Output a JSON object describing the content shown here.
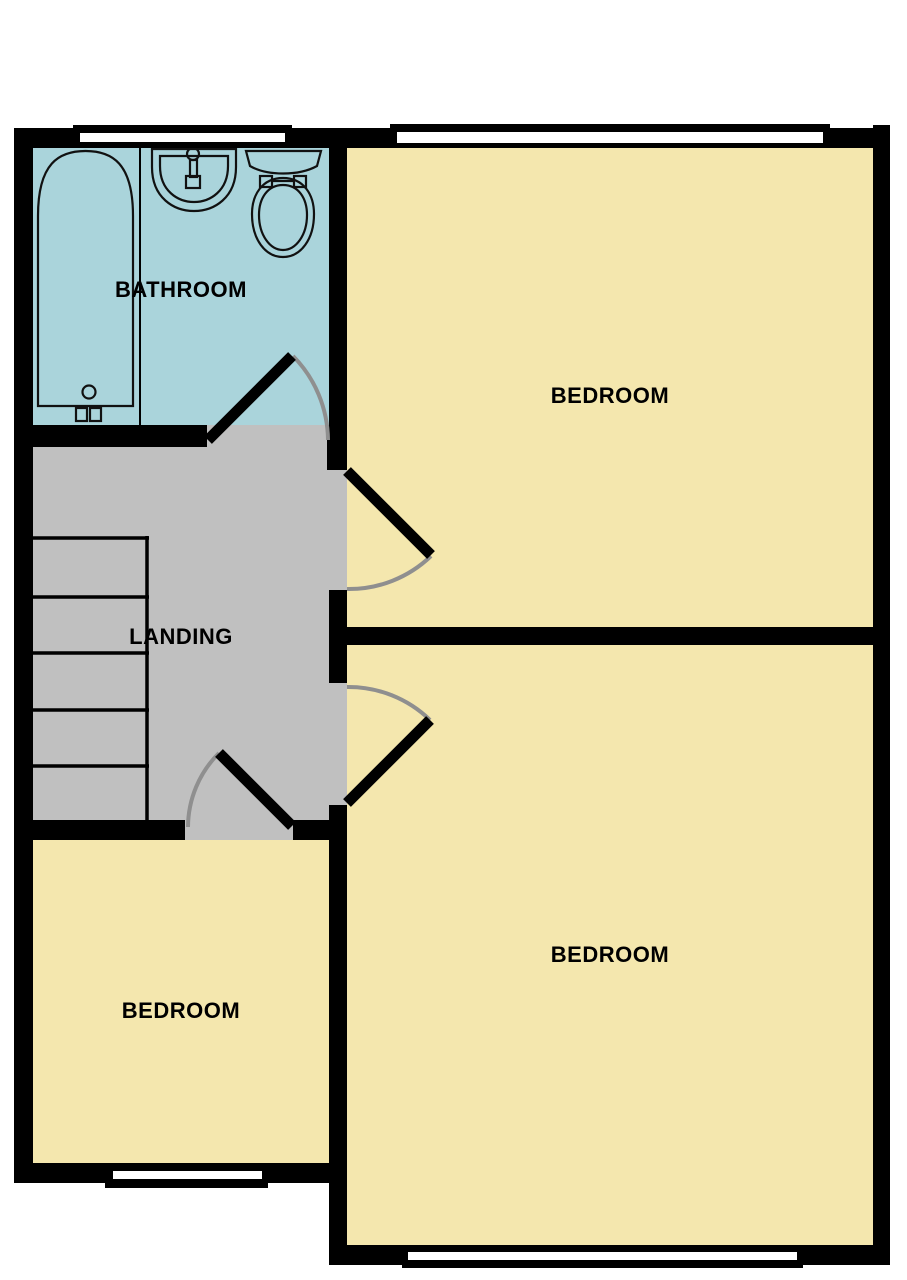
{
  "plan": {
    "type": "floorplan",
    "floor_labels_visible": 5,
    "colors": {
      "wall": "#000000",
      "bathroom_floor": "#aad4db",
      "bedroom_floor": "#f4e7ae",
      "landing_floor": "#c0c0c0",
      "window_glass": "#ffffff",
      "door_swing_arc": "#8f8f8f",
      "fixture_line": "#111111",
      "label_color": "#000000",
      "background": "#ffffff"
    },
    "rooms": {
      "bathroom": {
        "label": "BATHROOM"
      },
      "bedroom_top_right": {
        "label": "BEDROOM"
      },
      "landing": {
        "label": "LANDING"
      },
      "bedroom_bottom_right": {
        "label": "BEDROOM"
      },
      "bedroom_bottom_left": {
        "label": "BEDROOM"
      }
    },
    "fixtures": {
      "bath": "bath-tub-icon",
      "sink": "wash-basin-icon",
      "toilet": "toilet-icon",
      "stairs_treads": 5
    },
    "windows_count": 4,
    "doors_count": 4
  }
}
